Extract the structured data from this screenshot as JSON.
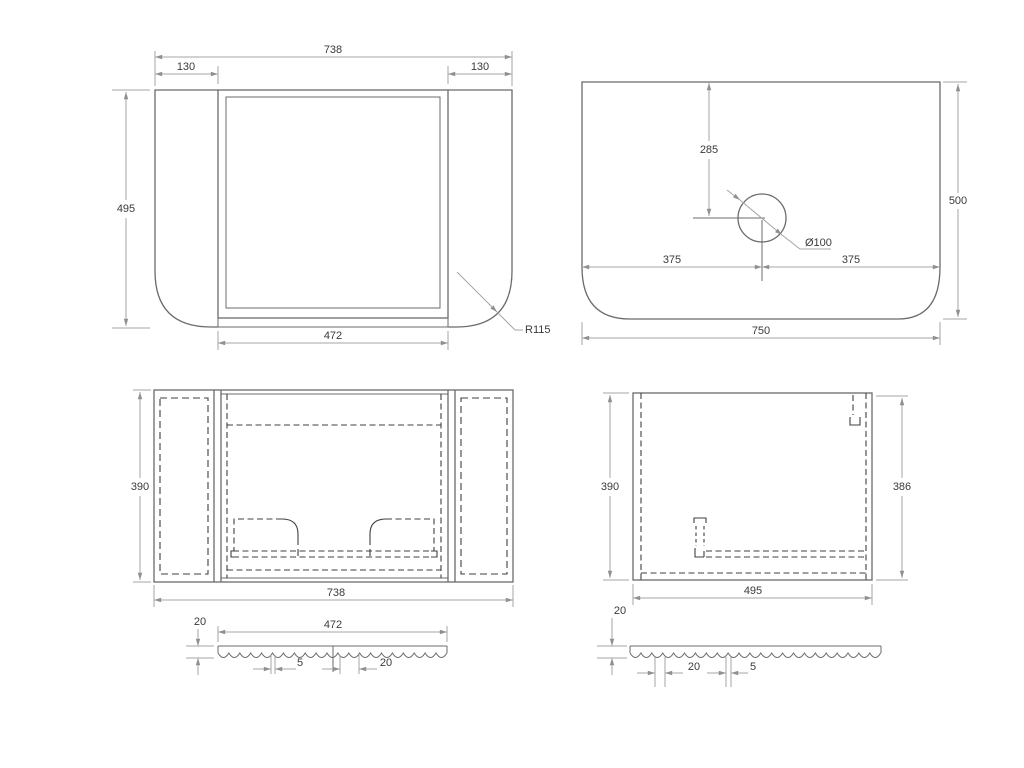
{
  "front_view": {
    "overall_width": "738",
    "left_panel_width": "130",
    "right_panel_width": "130",
    "height": "495",
    "opening_width": "472",
    "corner_radius": "R115"
  },
  "top_view": {
    "hole_offset_back": "285",
    "hole_diameter": "Ø100",
    "hole_offset_left": "375",
    "hole_offset_right": "375",
    "depth": "500",
    "width": "750"
  },
  "back_view": {
    "height": "390",
    "width": "738"
  },
  "side_view": {
    "height_left": "390",
    "height_right": "386",
    "depth": "495"
  },
  "detail_front_panel": {
    "width": "472",
    "thickness": "20",
    "groove_width": "5",
    "flute_pitch": "20"
  },
  "detail_side_panel": {
    "thickness": "20",
    "flute_pitch": "20",
    "groove_width": "5"
  }
}
